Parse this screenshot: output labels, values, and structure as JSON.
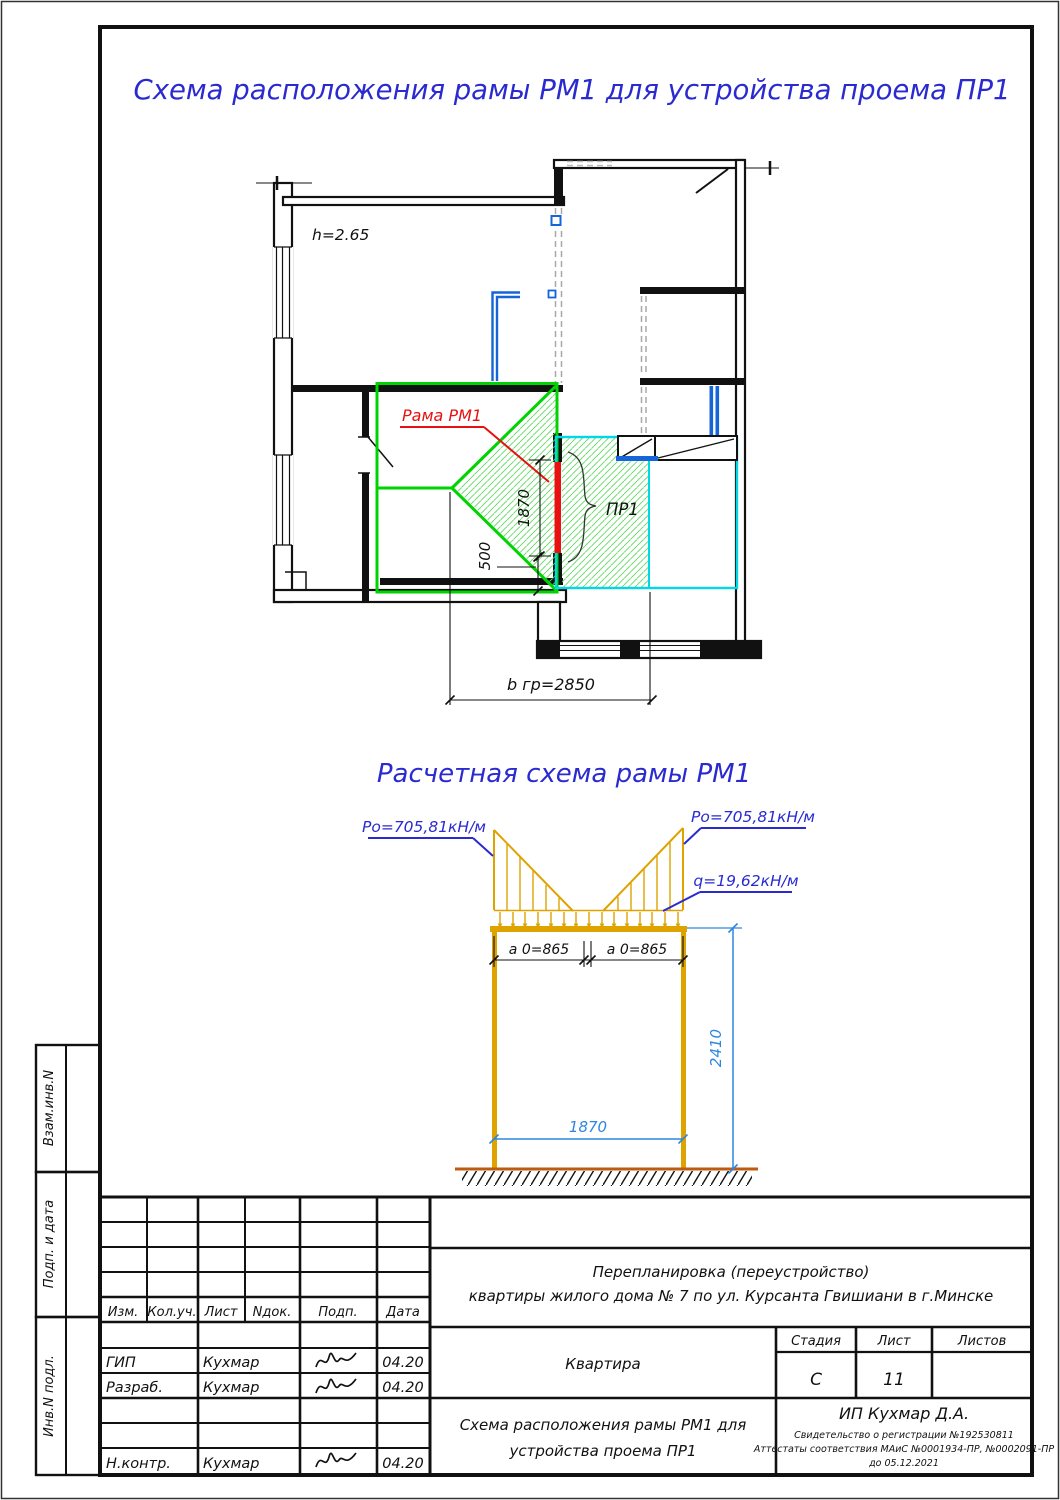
{
  "sheet": {
    "title_top": "Схема расположения рамы РМ1 для устройства проема ПР1",
    "scheme_title": "Расчетная схема рамы РМ1"
  },
  "plan": {
    "height_note": "h=2.65",
    "frame_label": "Рама РМ1",
    "opening_label": "ПР1",
    "dim_opening_height": "1870",
    "dim_pier": "500",
    "dim_width": "b гр=2850"
  },
  "scheme": {
    "load_left": "Po=705,81кН/м",
    "load_right": "Po=705,81кН/м",
    "load_q": "q=19,62кН/м",
    "dim_a_left": "a 0=865",
    "dim_a_right": "a 0=865",
    "dim_span": "1870",
    "dim_height": "2410"
  },
  "titleblock": {
    "columns": [
      "Изм.",
      "Кол.уч.",
      "Лист",
      "Nдок.",
      "Подп.",
      "Дата"
    ],
    "rows": [
      {
        "role": "ГИП",
        "name": "Кухмар",
        "date": "04.20"
      },
      {
        "role": "Разраб.",
        "name": "Кухмар",
        "date": "04.20"
      },
      {
        "role": "Н.контр.",
        "name": "Кухмар",
        "date": "04.20"
      }
    ],
    "project_line1": "Перепланировка (переустройство)",
    "project_line2": "квартиры жилого дома № 7 по ул. Курсанта Гвишиани в г.Минске",
    "object_name": "Квартира",
    "stage_label": "Стадия",
    "sheet_label": "Лист",
    "sheets_label": "Листов",
    "stage_value": "С",
    "sheet_value": "11",
    "sheets_value": "",
    "doc_line1": "Схема расположения рамы РМ1 для",
    "doc_line2": "устройства проема ПР1",
    "company": "ИП Кухмар Д.А.",
    "cert_line1": "Свидетельство о регистрации №192530811",
    "cert_line2": "Аттестаты соответствия МАиС №0001934-ПР, №0002091-ПР",
    "cert_line3": "до 05.12.2021"
  },
  "sidebar": {
    "labels": [
      "Взам.инв.N",
      "Подп. и дата",
      "Инв.N подл."
    ]
  },
  "colors": {
    "title_blue": "#2a2ad0",
    "dimension_blue": "#2e86e0",
    "frame_orange": "#dfa300",
    "ground_brown": "#c05a10",
    "zone_green": "#00d400",
    "hatch_green": "#5fd95f",
    "overlay_cyan": "#00d8e8",
    "marker_red": "#e81010",
    "pipe_blue": "#1565d8"
  }
}
